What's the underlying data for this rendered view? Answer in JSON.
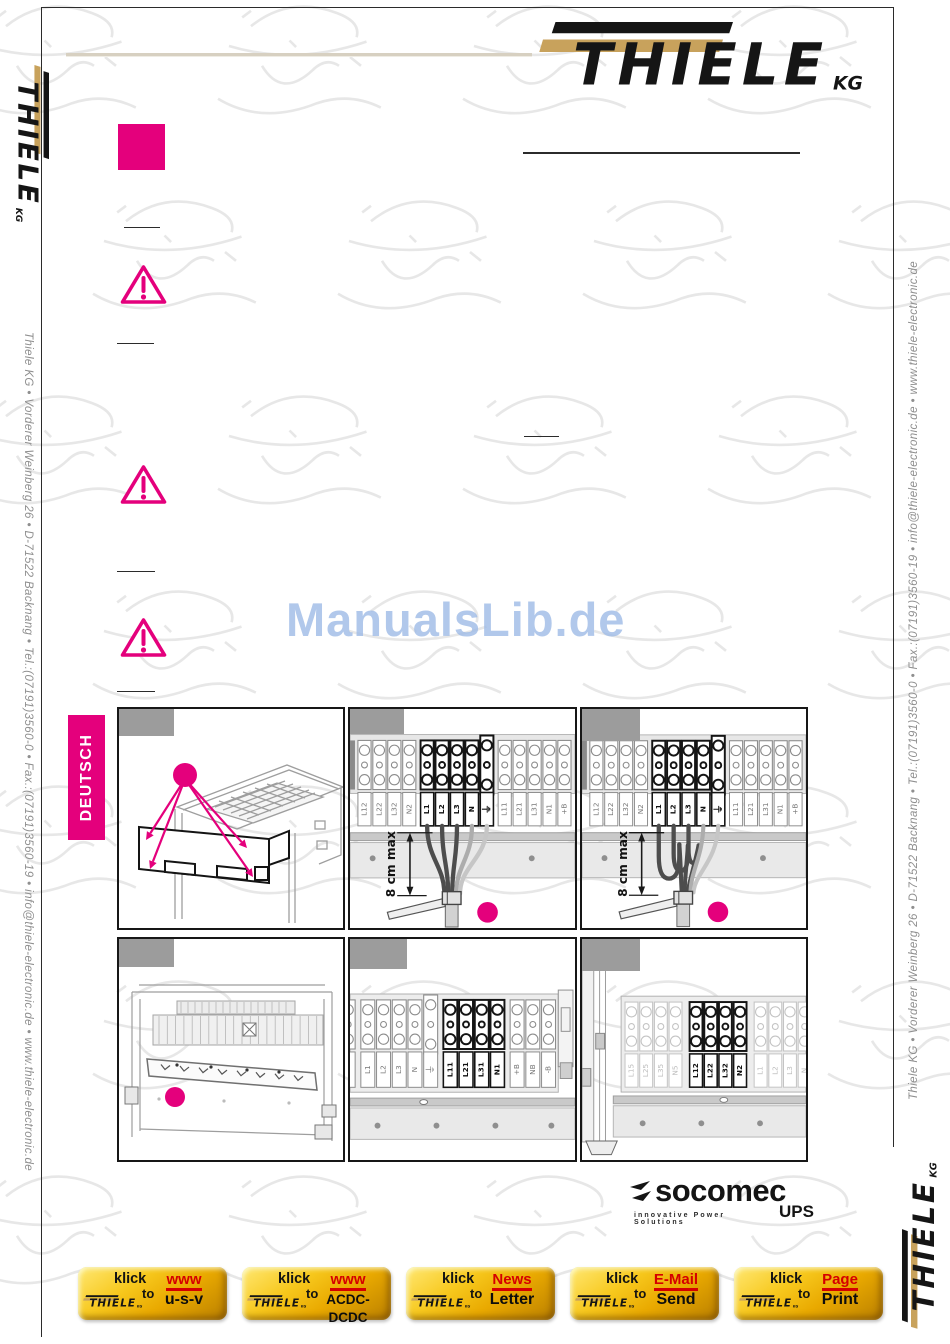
{
  "brand": {
    "name": "THIELE",
    "suffix": "KG"
  },
  "colors": {
    "magenta": "#E4007C",
    "gold": "#C8A25C",
    "watermark_blue": "#A8C2EA",
    "button_red": "#D50000"
  },
  "sidebar_left": {
    "contact": "Thiele KG • Vorderer Weinberg 26 • D-71522 Backnang • Tel.:(07191)3560-0 • Fax.:(07191)3560-19 • info@thiele-electronic.de • www.thiele-electronic.de"
  },
  "sidebar_right": {
    "contact": "Thiele KG • Vorderer Weinberg 26 • D-71522 Backnang • Tel.:(07191)3560-0 • Fax.:(07191)3560-19 • info@thiele-electronic.de • www.thiele-electronic.de"
  },
  "watermark": "ManualsLib.de",
  "language_tab": "DEUTSCH",
  "panels": {
    "wiring_straight": {
      "dimension": "8 cm max",
      "labels": [
        "L12",
        "L22",
        "L32",
        "N2",
        "L1",
        "L2",
        "L3",
        "N",
        "⏚",
        "L11",
        "L21",
        "L31",
        "N1",
        "+B"
      ],
      "bold": [
        4,
        5,
        6,
        7,
        8
      ]
    },
    "wiring_looped": {
      "dimension": "8 cm max",
      "labels": [
        "L12",
        "L22",
        "L32",
        "N2",
        "L1",
        "L2",
        "L3",
        "N",
        "⏚",
        "L11",
        "L21",
        "L31",
        "N1",
        "+B"
      ],
      "bold": [
        4,
        5,
        6,
        7,
        8
      ]
    },
    "output_terminals": {
      "labels": [
        "N2",
        "L1",
        "L2",
        "L3",
        "N",
        "⏚",
        "L11",
        "L21",
        "L31",
        "N1",
        "+B",
        "NB",
        "-B"
      ],
      "bold": [
        6,
        7,
        8,
        9
      ]
    },
    "bypass_terminals": {
      "labels": [
        "L15",
        "L25",
        "L35",
        "N5",
        "L12",
        "L22",
        "L32",
        "N2",
        "L1",
        "L2",
        "L3",
        "N",
        "⏚",
        "L11"
      ],
      "bold": [
        4,
        5,
        6,
        7
      ],
      "faint": [
        0,
        1,
        2,
        3,
        8,
        9,
        10,
        11,
        12,
        13
      ]
    }
  },
  "socomec": {
    "name": "socomec",
    "tagline": "innovative Power Solutions",
    "sub": "UPS"
  },
  "buttons": [
    {
      "klick": "klick",
      "to": "to",
      "brand": "THIELE",
      "red": "www",
      "black": "u-s-v"
    },
    {
      "klick": "klick",
      "to": "to",
      "brand": "THIELE",
      "red": "www",
      "black": "ACDC-",
      "black2": "DCDC"
    },
    {
      "klick": "klick",
      "to": "to",
      "brand": "THIELE",
      "red": "News",
      "black": "Letter"
    },
    {
      "klick": "klick",
      "to": "to",
      "brand": "THIELE",
      "red": "E-Mail",
      "black": "Send"
    },
    {
      "klick": "klick",
      "to": "to",
      "brand": "THIELE",
      "red": "Page",
      "black": "Print"
    }
  ]
}
